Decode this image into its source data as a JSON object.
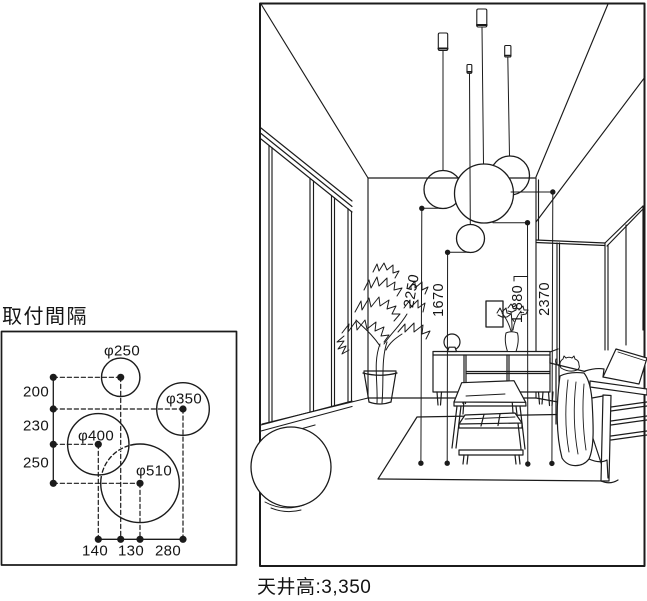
{
  "left_panel": {
    "title": "取付間隔",
    "fixtures": [
      {
        "label": "φ250"
      },
      {
        "label": "φ350"
      },
      {
        "label": "φ400"
      },
      {
        "label": "φ510"
      }
    ],
    "row_gaps": [
      {
        "value": "200"
      },
      {
        "value": "230"
      },
      {
        "value": "250"
      }
    ],
    "col_gaps": [
      {
        "value": "140"
      },
      {
        "value": "130"
      },
      {
        "value": "280"
      }
    ]
  },
  "room": {
    "pendant_drops": [
      {
        "value": "2250"
      },
      {
        "value": "1670"
      },
      {
        "value": "1,880"
      },
      {
        "value": "2370"
      }
    ],
    "ceiling_height_caption": "天井高:3,350"
  },
  "colors": {
    "line": "#1b1b1b",
    "background": "#ffffff"
  }
}
